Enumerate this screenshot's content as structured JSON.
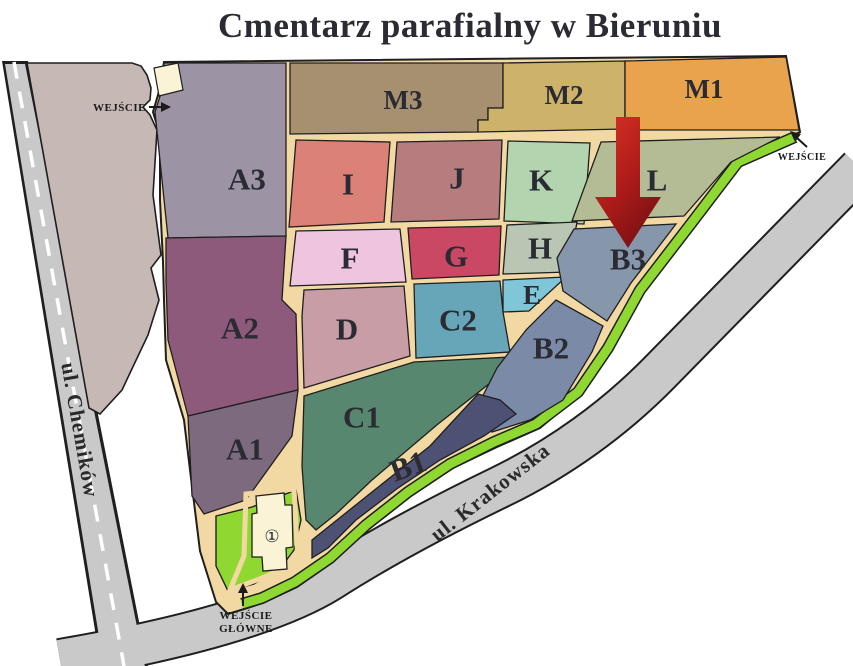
{
  "title": {
    "text": "Cmentarz parafialny w Bieruniu",
    "color": "#c4320a"
  },
  "roads": {
    "left": {
      "name": "ul. Chemików"
    },
    "bottom": {
      "name": "ul. Krakowska"
    }
  },
  "entrances": {
    "west": {
      "label": "WEJŚCIE"
    },
    "east": {
      "label": "WEJŚCIE"
    },
    "main": {
      "line1": "WEJŚCIE",
      "line2": "GŁÓWNE"
    }
  },
  "church": {
    "symbol": "①"
  },
  "sections": [
    {
      "id": "A3",
      "label": "A3",
      "color": "#9c93a4"
    },
    {
      "id": "A2",
      "label": "A2",
      "color": "#8e5a7c"
    },
    {
      "id": "A1",
      "label": "A1",
      "color": "#7d6a7f"
    },
    {
      "id": "M3",
      "label": "M3",
      "color": "#a69070"
    },
    {
      "id": "M2",
      "label": "M2",
      "color": "#ccb369"
    },
    {
      "id": "M1",
      "label": "M1",
      "color": "#e9a34d"
    },
    {
      "id": "I",
      "label": "I",
      "color": "#dc8178"
    },
    {
      "id": "J",
      "label": "J",
      "color": "#b67c7e"
    },
    {
      "id": "K",
      "label": "K",
      "color": "#b2d4ae"
    },
    {
      "id": "L",
      "label": "L",
      "color": "#b3bc94"
    },
    {
      "id": "F",
      "label": "F",
      "color": "#efc4df"
    },
    {
      "id": "G",
      "label": "G",
      "color": "#cb4865"
    },
    {
      "id": "H",
      "label": "H",
      "color": "#bac6b4"
    },
    {
      "id": "E",
      "label": "E",
      "color": "#7fc6d8"
    },
    {
      "id": "D",
      "label": "D",
      "color": "#c89da6"
    },
    {
      "id": "C2",
      "label": "C2",
      "color": "#67a6b8"
    },
    {
      "id": "C1",
      "label": "C1",
      "color": "#58876f"
    },
    {
      "id": "B3",
      "label": "B3",
      "color": "#8696ab"
    },
    {
      "id": "B2",
      "label": "B2",
      "color": "#7b8ba7"
    },
    {
      "id": "B1",
      "label": "B1",
      "color": "#4d5173"
    }
  ],
  "colors": {
    "path": "#f2d8a2",
    "road": "#c9c9c9",
    "parking": "#c6b8b4",
    "lawn": "#8fd831",
    "building": "#faf3d6",
    "arrow_start": "#d93425",
    "arrow_mid": "#b01c1a",
    "arrow_end": "#7d1113"
  }
}
